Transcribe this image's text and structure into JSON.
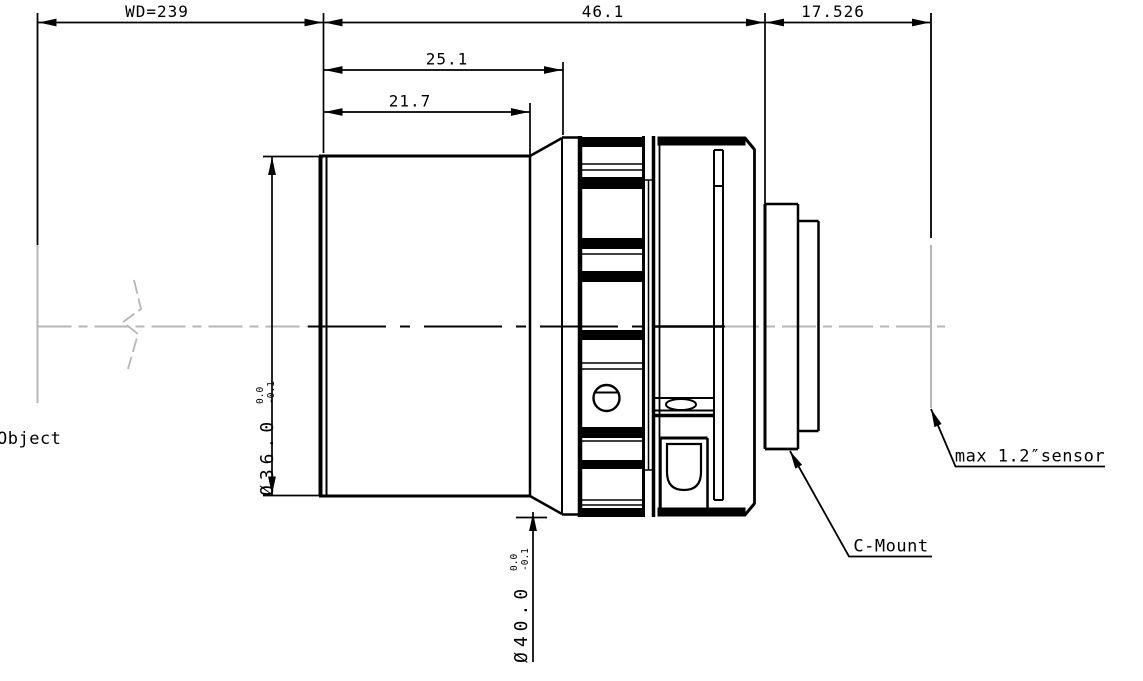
{
  "drawing": {
    "dimensions": {
      "working_distance": "WD=239",
      "barrel_to_flange": "46.1",
      "flange_focal_distance": "17.526",
      "front_section": "25.1",
      "front_barrel": "21.7",
      "front_diameter": {
        "value": "Ø36.0",
        "tol_upper": "0.0",
        "tol_lower": "-0.1"
      },
      "ring_diameter": {
        "value": "Ø40.0",
        "tol_upper": "0.0",
        "tol_lower": "-0.1"
      }
    },
    "labels": {
      "object_plane": "Object",
      "mount": "C-Mount",
      "sensor": "max 1.2″sensor"
    },
    "colors": {
      "line": "#000000",
      "guide": "#b6b6b6",
      "background": "#ffffff"
    }
  }
}
